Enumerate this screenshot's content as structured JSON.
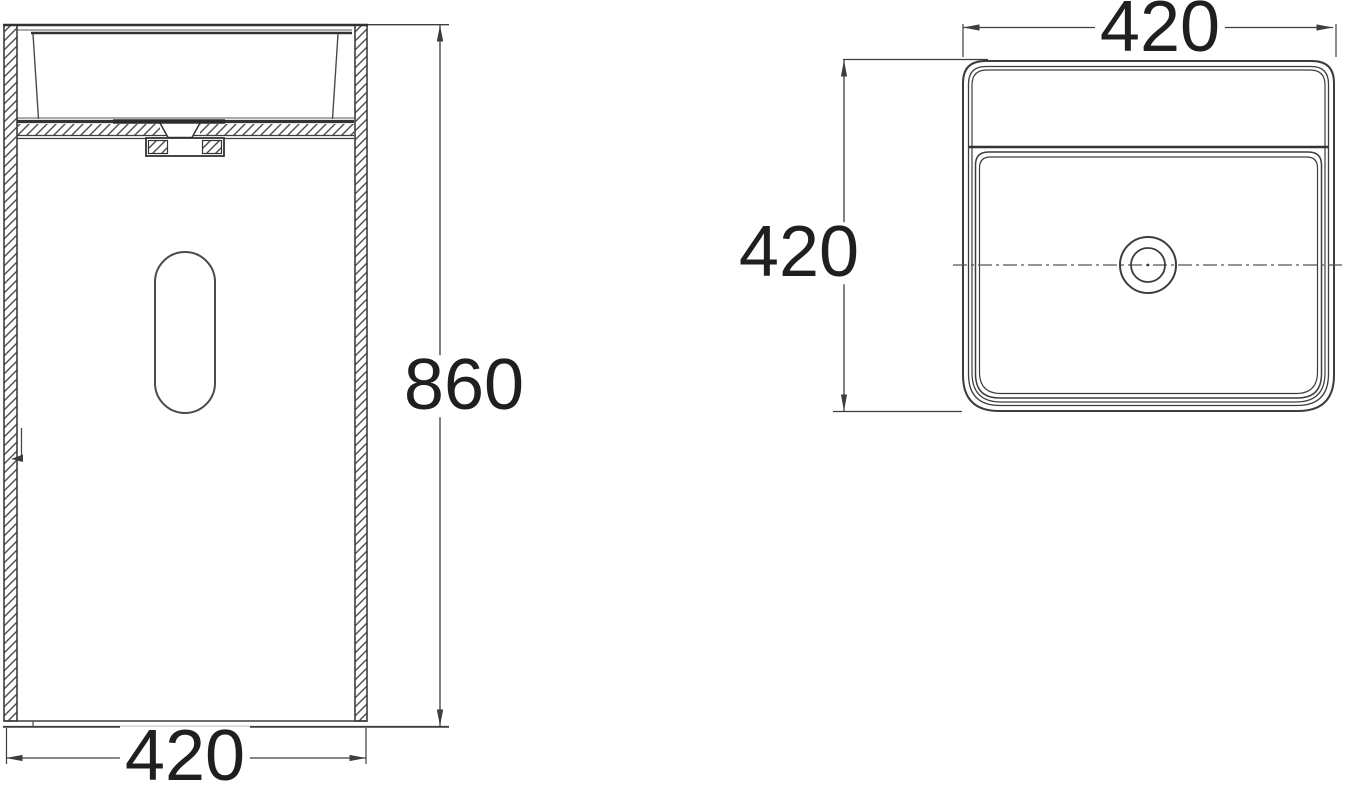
{
  "drawing": {
    "type": "technical-dimension-drawing",
    "subject": "freestanding-pedestal-washbasin",
    "front_view": {
      "height_label": "860",
      "width_label": "420"
    },
    "top_view": {
      "width_label": "420",
      "depth_label": "420"
    },
    "colors": {
      "line": "#3d3d3d",
      "dark_line": "#2e2e2e",
      "text": "#1f1f1f",
      "background": "#ffffff"
    }
  }
}
